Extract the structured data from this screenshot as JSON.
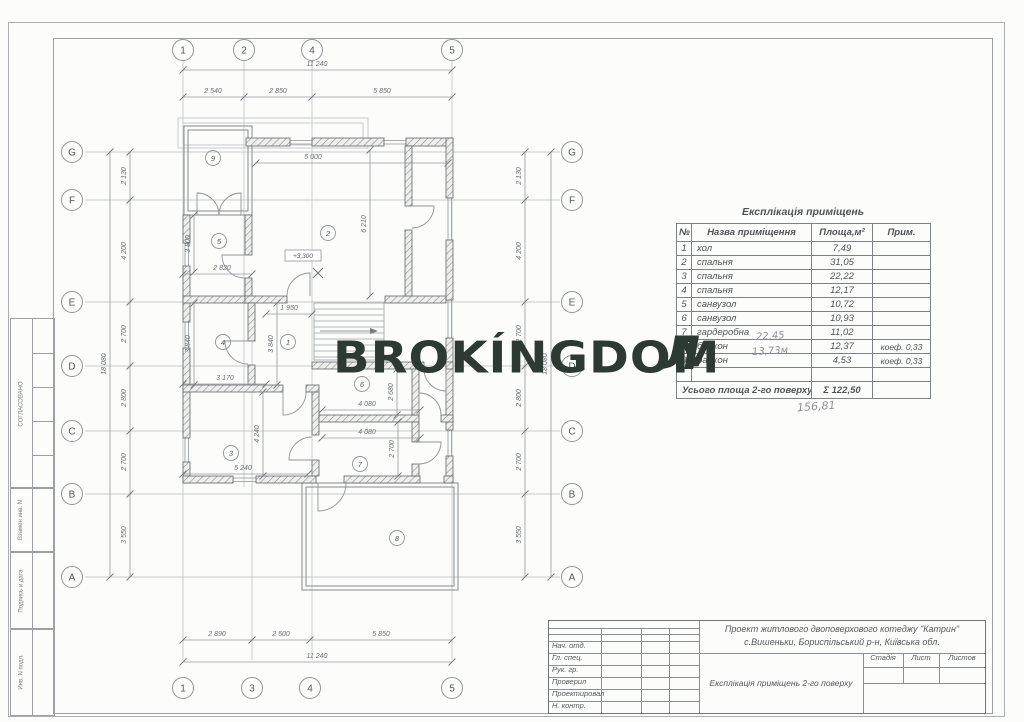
{
  "watermark": {
    "text": "BROKÍNGDOM",
    "stray_letter": "Л",
    "color": "#2c3a33"
  },
  "margin": {
    "approved": "СОГЛАСОВАНО",
    "replace_inv": "Взамен инв. N",
    "sign_date": "Подпись и дата",
    "inv_no": "Инв. N подл."
  },
  "plan": {
    "grid": {
      "top": [
        "1",
        "2",
        "4",
        "5"
      ],
      "bottom": [
        "1",
        "3",
        "4",
        "5"
      ],
      "side": [
        "G",
        "F",
        "E",
        "D",
        "C",
        "B",
        "A"
      ]
    },
    "dims": {
      "top_overall": "11 240",
      "top_segments": [
        "2 540",
        "2 850",
        "5 850"
      ],
      "bottom_segments": [
        "2 890",
        "2 500",
        "5 850"
      ],
      "bottom_overall": "11 240",
      "side_overall": "18 080",
      "side_segments": [
        "2 130",
        "4 200",
        "2 700",
        "2 800",
        "2 700",
        "3 550"
      ],
      "interior": [
        "5 000",
        "2 820",
        "1 950",
        "3 170",
        "5 240",
        "4 080",
        "4 080",
        "3 800",
        "3 840",
        "3 840",
        "6 210",
        "2 680",
        "4 240",
        "2 700"
      ]
    },
    "rooms": [
      "9",
      "5",
      "2",
      "4",
      "1",
      "6",
      "3",
      "7",
      "8"
    ],
    "level_mark": "+3,300"
  },
  "table": {
    "title": "Експлікація приміщень",
    "headers": [
      "№",
      "Назва приміщення",
      "Площа,м²",
      "Прим."
    ],
    "rows": [
      [
        "1",
        "хол",
        "7,49",
        ""
      ],
      [
        "2",
        "спальня",
        "31,05",
        ""
      ],
      [
        "3",
        "спальня",
        "22,22",
        ""
      ],
      [
        "4",
        "спальня",
        "12,17",
        ""
      ],
      [
        "5",
        "санвузол",
        "10,72",
        ""
      ],
      [
        "6",
        "санвузол",
        "10,93",
        ""
      ],
      [
        "7",
        "гардеробна",
        "11,02",
        ""
      ],
      [
        "8",
        "балкон",
        "12,37",
        "коеф. 0,33"
      ],
      [
        "9",
        "балкон",
        "4,53",
        "коеф. 0,33"
      ]
    ],
    "footer": {
      "label": "Усього площа 2-го поверху",
      "value": "Σ 122,50"
    },
    "handwritten": {
      "row8": "22,45",
      "row9": "13,73м",
      "below": "156,81"
    }
  },
  "title_block": {
    "project_line1": "Проект житлового двоповерхового котеджу \"Катрин\"",
    "project_line2": "с.Вишеньки, Бориспільський р-н, Київська обл.",
    "doc_title": "Експлікація приміщень 2-го поверху",
    "roles": [
      "Нач. отд.",
      "Гл. спец.",
      "Рук. гр.",
      "Проверил",
      "Проектировал",
      "Н. контр."
    ],
    "stage_cols": [
      "Стадія",
      "Лист",
      "Листов"
    ]
  }
}
